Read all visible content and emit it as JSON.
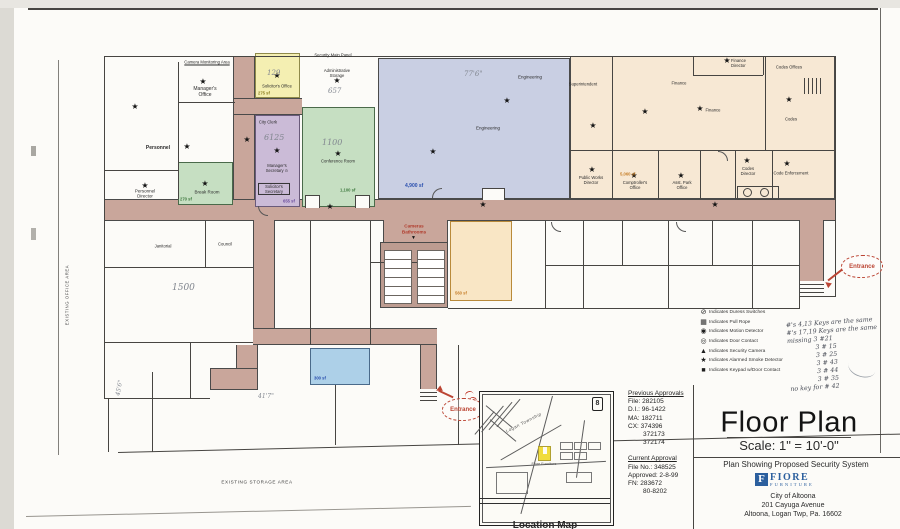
{
  "title_block": {
    "title": "Floor Plan",
    "scale": "Scale: 1\" = 10'-0\"",
    "subtitle": "Plan Showing Proposed Security System",
    "logo_letter": "F",
    "logo_name": "FIORE",
    "logo_word": "FURNITURE",
    "address1": "City of Altoona",
    "address2": "201 Cayuga Avenue",
    "address3": "Altoona, Logan Twp, Pa. 16602"
  },
  "approvals": {
    "previous_heading": "Previous Approvals",
    "previous": [
      "File: 282105",
      "D.I.: 96-1422",
      "MA: 182711",
      "CX: 374396",
      "372173",
      "372174"
    ],
    "current_heading": "Current Approval",
    "current": [
      "File No.: 348525",
      "Approved: 2-8-99",
      "FN: 283672",
      "80-8202"
    ]
  },
  "legend": {
    "items": [
      {
        "icon": "⊘",
        "label": "Indicates Duress Switches"
      },
      {
        "icon": "▦",
        "label": "Indicates Pull Rope"
      },
      {
        "icon": "◉",
        "label": "Indicates Motion Detector"
      },
      {
        "icon": "◎",
        "label": "Indicates Door Contact"
      },
      {
        "icon": "▲",
        "label": "Indicates Security Camera"
      },
      {
        "icon": "★",
        "label": "Indicates Alarmed Smoke Detector"
      },
      {
        "icon": "■",
        "label": "Indicates Keypad w/Door Contact"
      }
    ]
  },
  "notes": {
    "lines": [
      "#'s 4,13 Keys are the same",
      "#'s 17,19 Keys are the same",
      "missing 3 #21",
      "3 # 15",
      "3 # 25",
      "3 # 43",
      "3 # 44",
      "3 # 35",
      "no key for # 42"
    ]
  },
  "map": {
    "caption": "Location Map",
    "township": "Logan Township",
    "route_badge": "8",
    "marker_label": "Fiore Furniture"
  },
  "plan": {
    "camera_monitoring_label": "Camera Monitoring Area",
    "security_panel_label": "Security Main Panel",
    "cameras_bathrooms_label": "Cameras Bathrooms",
    "entrance_label": "Entrance",
    "existing_storage_label": "EXISTING STORAGE AREA",
    "existing_office_label": "EXISTING OFFICE AREA",
    "rooms": {
      "managers_office": "Manager's Office",
      "personnel": "Personnel",
      "personnel_director": "Personnel Director",
      "break_room": "Break Room",
      "solicitors_office": "Solicitor's Office",
      "city_clerk": "City Clerk",
      "managers_secretary": "Manager's Secretary ⊙",
      "solicitors_secretary": "Solicitor's Secretary",
      "admin_storage": "Administrative Storage",
      "conference_room": "Conference Room",
      "engineering": "Engineering",
      "superintendent": "Superintendent",
      "finance": "Finance",
      "finance_director": "Finance Director",
      "codes_offices": "Codes Offices",
      "codes": "Codes",
      "codes_director": "Codes Director",
      "code_enforcement": "Code Enforcement",
      "public_works_director": "Public Works Director",
      "comptrollers_office": "Comptroller's Office",
      "asst_park_office": "Asst. Park Office",
      "janitorial": "Janitorial",
      "council": "Council"
    },
    "areas": {
      "break_room_sf": "270 sf",
      "solicitors_office_sf": "275 sf",
      "city_clerk_sf": "655 sf",
      "conference_sf": "1,100 sf",
      "engineering_sf": "4,900 sf",
      "finance_wing_sf": "5,060 sf",
      "center_room_sf": "560 sf",
      "lower_room_sf": "300 sf"
    },
    "handwritten": {
      "a129": "129",
      "a6125": "6125",
      "a1100": "1100",
      "a657": "657",
      "a77": "77'6\"",
      "a1500": "1500",
      "a41": "41'7\"",
      "a45": "45'6\""
    }
  },
  "icons": {
    "star": "★",
    "down_arrow": "▼"
  }
}
